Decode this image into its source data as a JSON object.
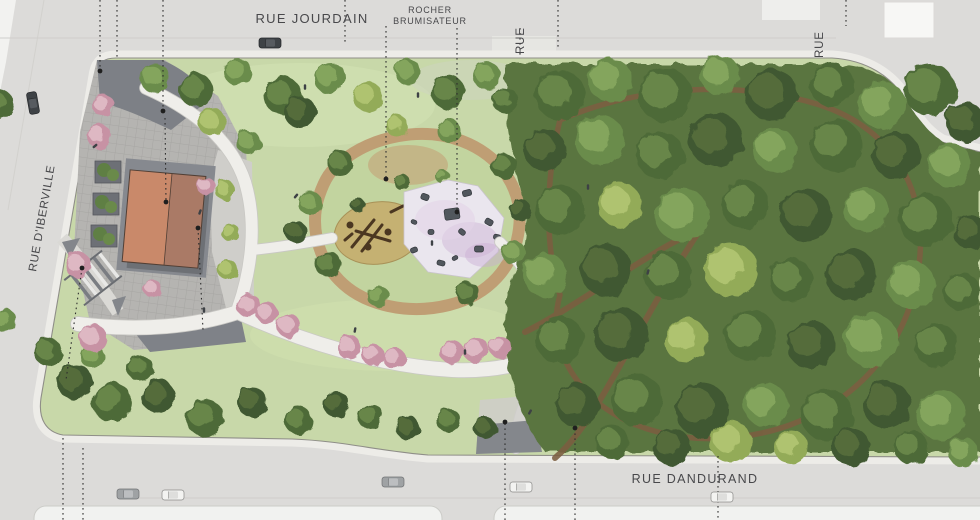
{
  "canvas": {
    "width": 980,
    "height": 520
  },
  "labels": {
    "street_top": "RUE JOURDAIN",
    "feature_line1": "ROCHER",
    "feature_line2": "BRUMISATEUR",
    "street_stub_top_center": "RUE",
    "street_stub_top_right": "RUE",
    "street_left": "RUE D'IBERVILLE",
    "street_bottom": "RUE DANDURAND"
  },
  "colors": {
    "street": "#dcdbd9",
    "sidewalk": "#edece8",
    "curb": "#8f8e88",
    "lawn": "#c8d8a9",
    "woodland": "#5a7540",
    "plaza_medium": "#b5b4b1",
    "plaza_dark": "#7d8086",
    "paving_pale": "#cfceca",
    "roof_left": "#c9896a",
    "roof_right": "#aa7a66",
    "sand": "#c5b172",
    "splash_pad": "#eae6ee",
    "ring_path": "#bf9e74",
    "dirt_path": "#7c5e41",
    "path_white": "#efeeea",
    "cherry": "#c792a4",
    "text": "#48484b",
    "tree_palettes": {
      "v0": [
        "#6b8c4c",
        "#87a75f"
      ],
      "v1": [
        "#4e6b38",
        "#6a8a4a"
      ],
      "v2": [
        "#93ab58",
        "#b3c573"
      ],
      "v3": [
        "#3f5830",
        "#566f3d"
      ],
      "cherry": [
        "#c792a4",
        "#e0bcc6"
      ]
    },
    "cars": {
      "dark": [
        "#3e4246",
        "#575b60",
        "#26282b"
      ],
      "gray": [
        "#9fa2a4",
        "#bcbec0",
        "#6f7173"
      ],
      "white": [
        "#f3f3f1",
        "#dededc",
        "#8a8a88"
      ]
    }
  },
  "map": {
    "trees": {
      "wood": [
        [
          560,
          95,
          25,
          1
        ],
        [
          610,
          80,
          22,
          0
        ],
        [
          665,
          95,
          27,
          1
        ],
        [
          720,
          75,
          20,
          0
        ],
        [
          772,
          95,
          26,
          3
        ],
        [
          832,
          85,
          22,
          1
        ],
        [
          882,
          105,
          24,
          0
        ],
        [
          930,
          90,
          26,
          1
        ],
        [
          965,
          122,
          20,
          3
        ],
        [
          545,
          150,
          21,
          3
        ],
        [
          600,
          140,
          25,
          0
        ],
        [
          660,
          155,
          24,
          1
        ],
        [
          716,
          140,
          27,
          3
        ],
        [
          775,
          150,
          22,
          0
        ],
        [
          836,
          145,
          26,
          1
        ],
        [
          896,
          155,
          24,
          3
        ],
        [
          950,
          165,
          22,
          0
        ],
        [
          560,
          210,
          25,
          1
        ],
        [
          620,
          205,
          22,
          2
        ],
        [
          682,
          215,
          27,
          0
        ],
        [
          745,
          205,
          24,
          1
        ],
        [
          806,
          215,
          26,
          3
        ],
        [
          866,
          210,
          22,
          0
        ],
        [
          926,
          220,
          27,
          1
        ],
        [
          970,
          232,
          17,
          3
        ],
        [
          545,
          275,
          22,
          0
        ],
        [
          606,
          270,
          26,
          3
        ],
        [
          668,
          275,
          24,
          1
        ],
        [
          731,
          270,
          27,
          2
        ],
        [
          791,
          280,
          22,
          1
        ],
        [
          851,
          275,
          26,
          3
        ],
        [
          911,
          285,
          24,
          0
        ],
        [
          962,
          292,
          19,
          1
        ],
        [
          560,
          340,
          24,
          1
        ],
        [
          621,
          335,
          27,
          3
        ],
        [
          686,
          340,
          22,
          2
        ],
        [
          750,
          335,
          26,
          1
        ],
        [
          811,
          345,
          24,
          3
        ],
        [
          871,
          340,
          27,
          0
        ],
        [
          936,
          345,
          22,
          1
        ],
        [
          577,
          405,
          22,
          3
        ],
        [
          637,
          400,
          26,
          1
        ],
        [
          702,
          410,
          27,
          3
        ],
        [
          766,
          405,
          22,
          0
        ],
        [
          827,
          415,
          26,
          1
        ],
        [
          887,
          405,
          24,
          3
        ],
        [
          941,
          415,
          25,
          0
        ],
        [
          612,
          442,
          17,
          1
        ],
        [
          672,
          447,
          19,
          3
        ],
        [
          731,
          442,
          21,
          2
        ],
        [
          791,
          447,
          17,
          2
        ],
        [
          851,
          447,
          19,
          3
        ],
        [
          911,
          447,
          17,
          1
        ],
        [
          963,
          452,
          15,
          0
        ]
      ],
      "west": [
        [
          155,
          78,
          15,
          0
        ],
        [
          196,
          90,
          17,
          1
        ],
        [
          238,
          72,
          14,
          0
        ],
        [
          283,
          96,
          19,
          1
        ],
        [
          300,
          112,
          16,
          3
        ],
        [
          330,
          78,
          16,
          0
        ],
        [
          368,
          97,
          15,
          2
        ],
        [
          408,
          72,
          13,
          0
        ],
        [
          448,
          92,
          17,
          1
        ],
        [
          487,
          76,
          14,
          0
        ],
        [
          505,
          100,
          13,
          1
        ],
        [
          340,
          163,
          13,
          1
        ],
        [
          310,
          203,
          12,
          0
        ],
        [
          328,
          264,
          13,
          1
        ],
        [
          378,
          296,
          11,
          0
        ],
        [
          468,
          294,
          12,
          1
        ],
        [
          514,
          253,
          12,
          0
        ],
        [
          504,
          166,
          13,
          1
        ],
        [
          449,
          131,
          12,
          0
        ],
        [
          397,
          126,
          11,
          2
        ],
        [
          296,
          232,
          11,
          3
        ],
        [
          520,
          210,
          11,
          3
        ],
        [
          402,
          182,
          8,
          1
        ],
        [
          442,
          176,
          7,
          0
        ],
        [
          358,
          205,
          7,
          3
        ],
        [
          48,
          352,
          14,
          1
        ],
        [
          75,
          382,
          18,
          3
        ],
        [
          112,
          402,
          20,
          1
        ],
        [
          158,
          396,
          17,
          3
        ],
        [
          205,
          418,
          19,
          1
        ],
        [
          252,
          402,
          15,
          3
        ],
        [
          298,
          420,
          14,
          1
        ],
        [
          336,
          404,
          13,
          3
        ],
        [
          140,
          368,
          13,
          1
        ],
        [
          92,
          356,
          12,
          0
        ],
        [
          370,
          416,
          13,
          1
        ],
        [
          408,
          428,
          12,
          3
        ],
        [
          448,
          420,
          12,
          1
        ],
        [
          485,
          428,
          11,
          3
        ],
        [
          212,
          122,
          14,
          2
        ],
        [
          248,
          142,
          12,
          0
        ],
        [
          0,
          104,
          14,
          1
        ],
        [
          4,
          320,
          12,
          0
        ],
        [
          225,
          190,
          10,
          2
        ],
        [
          230,
          232,
          9,
          2
        ],
        [
          228,
          270,
          10,
          2
        ]
      ],
      "cherry": [
        [
          103,
          105,
          11
        ],
        [
          99,
          136,
          12
        ],
        [
          78,
          265,
          13
        ],
        [
          93,
          338,
          14
        ],
        [
          152,
          288,
          9
        ],
        [
          206,
          186,
          9
        ],
        [
          248,
          305,
          12
        ],
        [
          267,
          313,
          11
        ],
        [
          289,
          326,
          12
        ],
        [
          349,
          347,
          12
        ],
        [
          373,
          355,
          11
        ],
        [
          394,
          358,
          11
        ],
        [
          452,
          352,
          12
        ],
        [
          476,
          350,
          13
        ],
        [
          500,
          347,
          11
        ]
      ]
    },
    "cars": [
      [
        270,
        43,
        0,
        "dark"
      ],
      [
        33,
        103,
        80,
        "dark"
      ],
      [
        128,
        494,
        0,
        "gray"
      ],
      [
        173,
        495,
        0,
        "white"
      ],
      [
        393,
        482,
        0,
        "gray"
      ],
      [
        521,
        487,
        0,
        "white"
      ],
      [
        722,
        497,
        0,
        "white"
      ]
    ],
    "lot_lines": [
      {
        "pts": [
          [
            100,
            0
          ],
          [
            100,
            71
          ]
        ],
        "dot": [
          100,
          71
        ]
      },
      {
        "pts": [
          [
            117,
            0
          ],
          [
            117,
            57
          ]
        ],
        "dot": null
      },
      {
        "pts": [
          [
            163,
            0
          ],
          [
            163,
            111
          ]
        ],
        "dot": [
          163,
          111
        ]
      },
      {
        "pts": [
          [
            165,
            118
          ],
          [
            166,
            202
          ]
        ],
        "dot": [
          166,
          202
        ]
      },
      {
        "pts": [
          [
            345,
            0
          ],
          [
            345,
            42
          ]
        ],
        "dot": null
      },
      {
        "pts": [
          [
            386,
            26
          ],
          [
            386,
            179
          ]
        ],
        "dot": [
          386,
          179
        ]
      },
      {
        "pts": [
          [
            457,
            28
          ],
          [
            457,
            212
          ]
        ],
        "dot": [
          457,
          212
        ]
      },
      {
        "pts": [
          [
            520,
            28
          ],
          [
            520,
            56
          ]
        ],
        "dot": null
      },
      {
        "pts": [
          [
            558,
            0
          ],
          [
            558,
            48
          ]
        ],
        "dot": null
      },
      {
        "pts": [
          [
            846,
            0
          ],
          [
            846,
            26
          ]
        ],
        "dot": null
      },
      {
        "pts": [
          [
            505,
            520
          ],
          [
            505,
            422
          ]
        ],
        "dot": [
          505,
          422
        ]
      },
      {
        "pts": [
          [
            575,
            520
          ],
          [
            575,
            428
          ]
        ],
        "dot": [
          575,
          428
        ]
      },
      {
        "pts": [
          [
            718,
            456
          ],
          [
            718,
            520
          ]
        ],
        "dot": null
      },
      {
        "pts": [
          [
            82,
            268
          ],
          [
            66,
            380
          ]
        ],
        "dot": [
          82,
          268
        ]
      },
      {
        "pts": [
          [
            63,
            438
          ],
          [
            63,
            520
          ]
        ],
        "dot": null
      },
      {
        "pts": [
          [
            83,
            448
          ],
          [
            83,
            520
          ]
        ],
        "dot": null
      },
      {
        "pts": [
          [
            198,
            228
          ],
          [
            203,
            330
          ]
        ],
        "dot": [
          198,
          228
        ]
      }
    ],
    "people": [
      [
        200,
        212,
        20
      ],
      [
        305,
        87,
        0
      ],
      [
        296,
        196,
        40
      ],
      [
        432,
        243,
        0
      ],
      [
        355,
        330,
        10
      ],
      [
        465,
        352,
        0
      ],
      [
        204,
        310,
        0
      ],
      [
        530,
        412,
        30
      ],
      [
        588,
        187,
        0
      ],
      [
        648,
        272,
        15
      ],
      [
        95,
        146,
        50
      ],
      [
        418,
        95,
        0
      ]
    ],
    "rocks": [
      [
        452,
        214,
        15,
        11,
        -8
      ],
      [
        425,
        197,
        8,
        6,
        20
      ],
      [
        467,
        193,
        9,
        6,
        -15
      ],
      [
        489,
        222,
        8,
        6,
        30
      ],
      [
        479,
        249,
        9,
        6,
        0
      ],
      [
        441,
        263,
        8,
        5,
        15
      ],
      [
        414,
        250,
        7,
        5,
        -20
      ],
      [
        462,
        232,
        7,
        5,
        40
      ],
      [
        431,
        232,
        6,
        5,
        0
      ],
      [
        414,
        222,
        6,
        4,
        25
      ],
      [
        497,
        237,
        7,
        5,
        10
      ],
      [
        455,
        258,
        6,
        4,
        -30
      ]
    ],
    "planters": [
      [
        108,
        172
      ],
      [
        106,
        204
      ],
      [
        104,
        236
      ]
    ]
  }
}
